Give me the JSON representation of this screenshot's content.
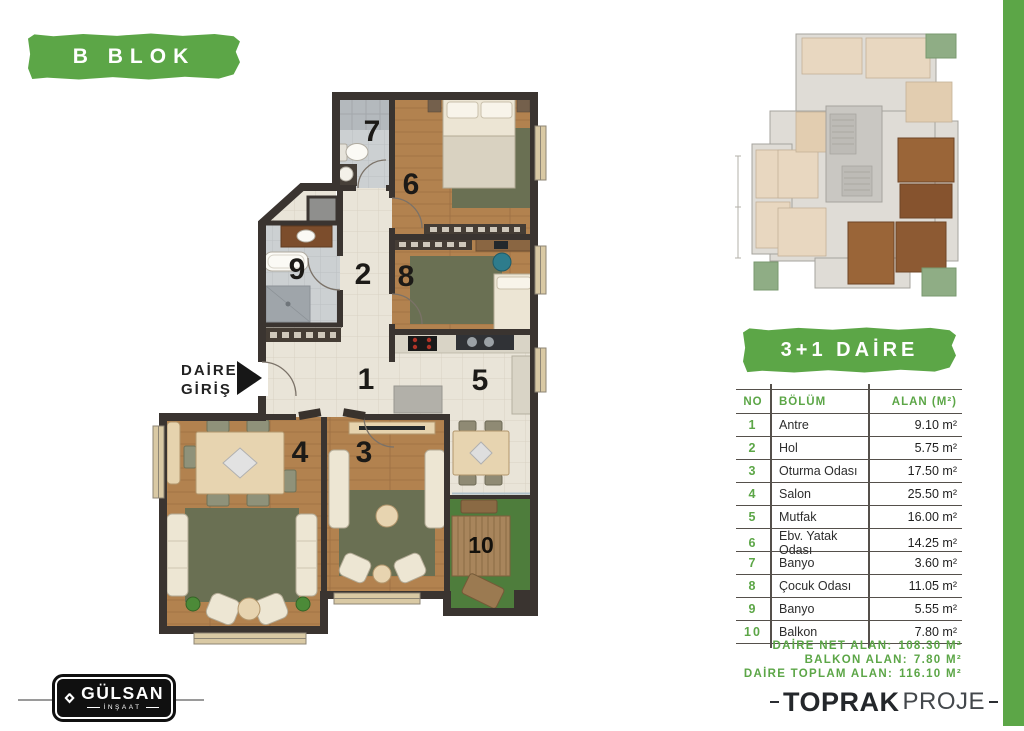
{
  "colors": {
    "accent_green": "#5ca647",
    "wall": "#3a3430",
    "wood": "#b2824f",
    "rug": "#6a7053",
    "tile": "#e9e4d8",
    "grass": "#4e7d3c"
  },
  "block_label": "B BLOK",
  "unit_type_label": "3+1 DAİRE",
  "plan": {
    "entry": {
      "line1": "DAİRE",
      "line2": "GİRİŞ"
    },
    "room_numbers": {
      "r1": "1",
      "r2": "2",
      "r3": "3",
      "r4": "4",
      "r5": "5",
      "r6": "6",
      "r7": "7",
      "r8": "8",
      "r9": "9",
      "r10": "10"
    }
  },
  "area_table": {
    "headers": {
      "no": "NO",
      "section": "BÖLÜM",
      "area": "ALAN (M²)"
    },
    "rows": [
      {
        "no": "1",
        "section": "Antre",
        "area": "9.10 m²"
      },
      {
        "no": "2",
        "section": "Hol",
        "area": "5.75 m²"
      },
      {
        "no": "3",
        "section": "Oturma Odası",
        "area": "17.50 m²"
      },
      {
        "no": "4",
        "section": "Salon",
        "area": "25.50 m²"
      },
      {
        "no": "5",
        "section": "Mutfak",
        "area": "16.00 m²"
      },
      {
        "no": "6",
        "section": "Ebv. Yatak Odası",
        "area": "14.25 m²"
      },
      {
        "no": "7",
        "section": "Banyo",
        "area": "3.60 m²"
      },
      {
        "no": "8",
        "section": "Çocuk Odası",
        "area": "11.05 m²"
      },
      {
        "no": "9",
        "section": "Banyo",
        "area": "5.55 m²"
      },
      {
        "no": "10",
        "section": "Balkon",
        "area": "7.80 m²"
      }
    ]
  },
  "summary": {
    "net": {
      "label": "DAİRE NET ALAN:",
      "value": "108.30 M²"
    },
    "balcony": {
      "label": "BALKON ALAN:",
      "value": "7.80 M²"
    },
    "total": {
      "label": "DAİRE TOPLAM ALAN:",
      "value": "116.10 M²"
    }
  },
  "footer": {
    "builder": {
      "name": "GÜLSAN",
      "subtitle": "İNŞAAT"
    },
    "designer": {
      "name": "TOPRAK",
      "subtitle": "PROJE"
    }
  }
}
